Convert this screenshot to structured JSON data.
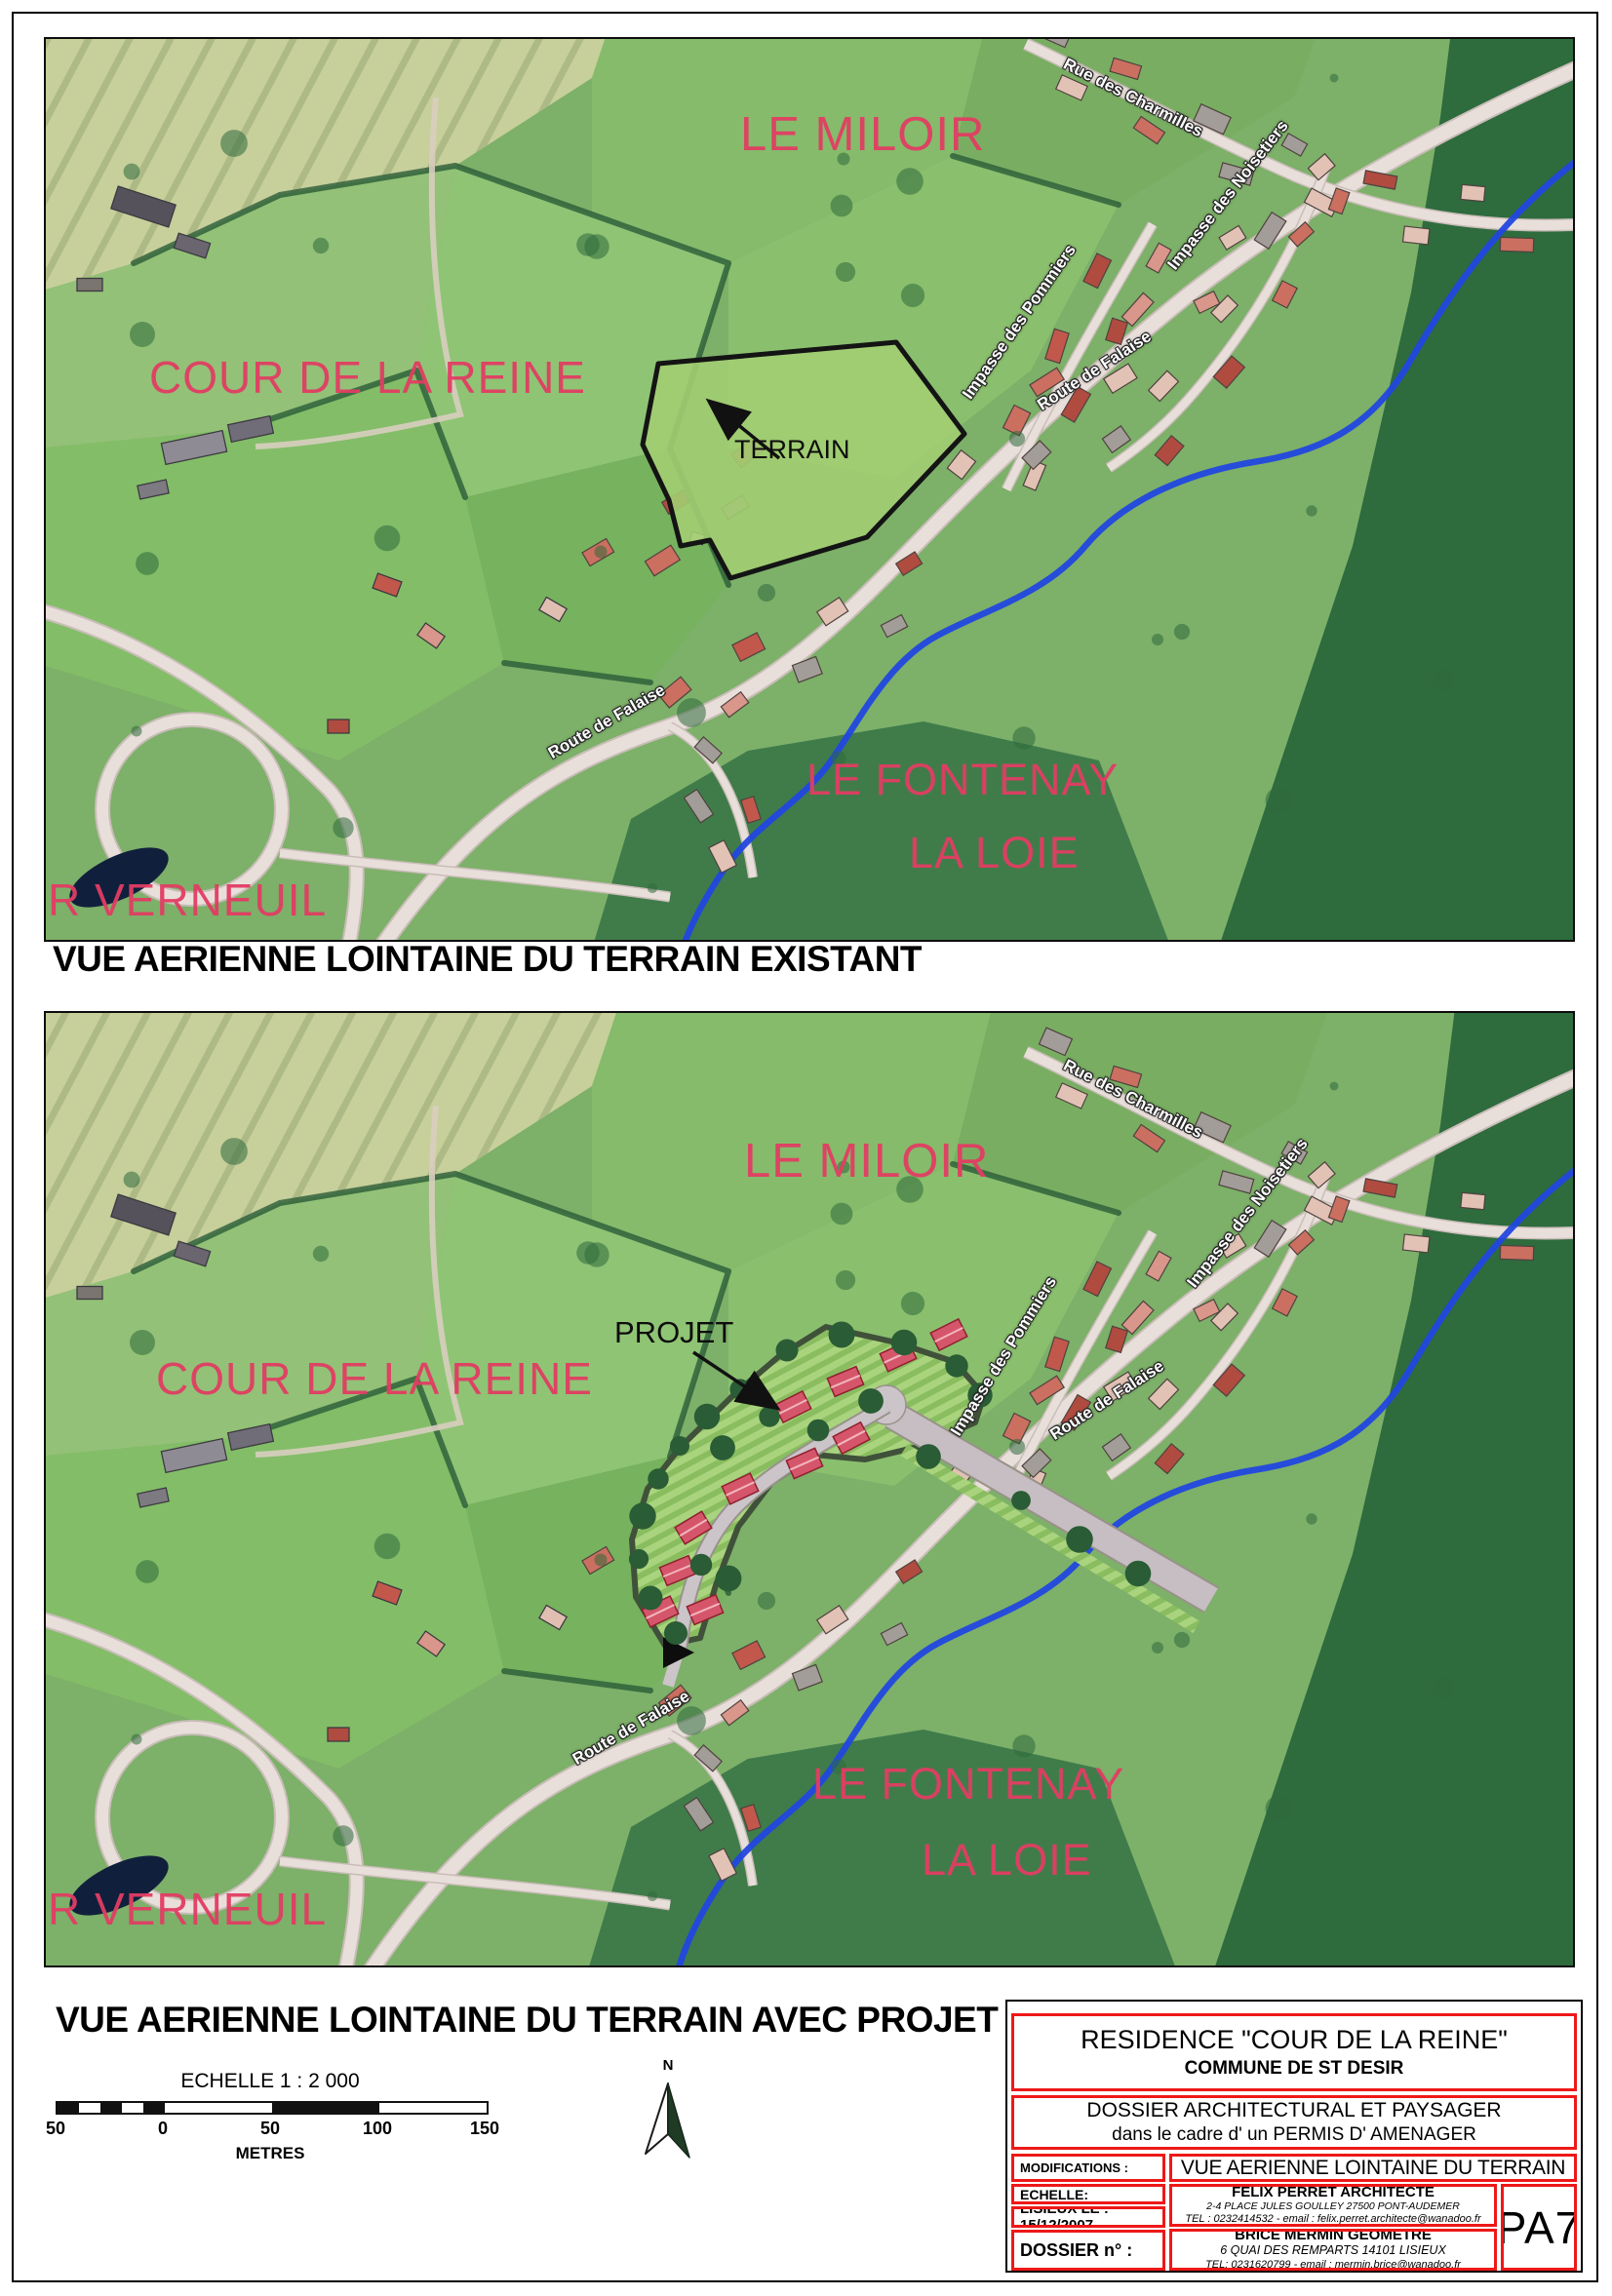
{
  "document": {
    "captions": {
      "existing": "VUE AERIENNE LOINTAINE DU TERRAIN EXISTANT",
      "project": "VUE AERIENNE LOINTAINE DU TERRAIN AVEC PROJET"
    }
  },
  "map_existing": {
    "labels": {
      "le_miloir": "LE MILOIR",
      "cour_de_la_reine": "COUR DE LA REINE",
      "terrain": "TERRAIN",
      "le_fontenay": "LE FONTENAY",
      "la_loie": "LA LOIE",
      "r_verneuil": "R VERNEUIL"
    },
    "streets": {
      "rue_des_charmilles": "Rue des Charmilles",
      "impasse_des_noisetiers": "Impasse des Noisetiers",
      "impasse_des_pommiers": "Impasse des Pommiers",
      "route_de_falaise_upper": "Route de Falaise",
      "route_de_falaise_lower": "Route de Falaise"
    }
  },
  "map_project": {
    "labels": {
      "le_miloir": "LE MILOIR",
      "cour_de_la_reine": "COUR DE LA REINE",
      "projet": "PROJET",
      "le_fontenay": "LE FONTENAY",
      "la_loie": "LA LOIE",
      "r_verneuil": "R VERNEUIL"
    },
    "streets": {
      "rue_des_charmilles": "Rue des Charmilles",
      "impasse_des_noisetiers": "Impasse des Noisetiers",
      "impasse_des_pommiers": "Impasse des Pommiers",
      "route_de_falaise_upper": "Route de Falaise",
      "route_de_falaise_lower": "Route de Falaise"
    }
  },
  "scale_bar": {
    "title": "ECHELLE 1 : 2 000",
    "ticks": [
      "50",
      "0",
      "50",
      "100",
      "150"
    ],
    "unit": "METRES"
  },
  "north_arrow": {
    "label": "N"
  },
  "title_block": {
    "residence": "RESIDENCE \"COUR DE LA REINE\"",
    "commune": "COMMUNE DE  ST DESIR",
    "dossier_line1": "DOSSIER ARCHITECTURAL ET PAYSAGER",
    "dossier_line2": "dans le cadre d' un PERMIS D' AMENAGER",
    "modifications_label": "MODIFICATIONS :",
    "sheet_title": "VUE AERIENNE LOINTAINE DU TERRAIN",
    "echelle_label": "ECHELLE:",
    "date_label": "LISIEUX LE :  15/12/2007",
    "dossier_num_label": "DOSSIER n° :",
    "architect": {
      "name": "FELIX PERRET ARCHITECTE",
      "address": "2-4 PLACE JULES GOULLEY 27500 PONT-AUDEMER",
      "contact": "TEL : 0232414532 - email : felix.perret.architecte@wanadoo.fr"
    },
    "geometre": {
      "name": "BRICE MERMIN GEOMETRE",
      "address": "6 QUAI DES REMPARTS  14101 LISIEUX",
      "contact": "TEL: 0231620799 - email : mermin.brice@wanadoo.fr"
    },
    "sheet_number": "PA7"
  },
  "colors": {
    "place_label_pink": "#e23d63",
    "title_block_border_red": "#ee1818",
    "river_blue": "#2247e0",
    "terrain_outline_black": "#141414",
    "project_lot_green": "#a9d47d",
    "project_roof_red": "#d5566a"
  }
}
